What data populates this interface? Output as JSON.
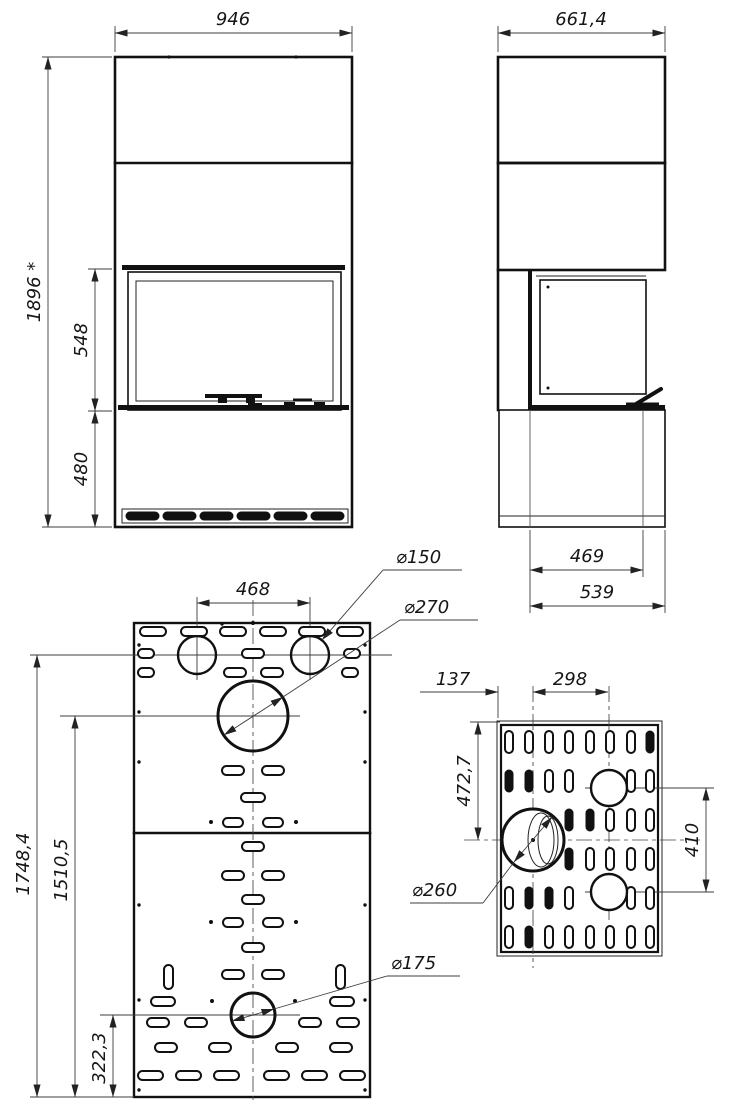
{
  "drawing": {
    "title": "Fireplace dimensional drawing",
    "line_color": "#111111",
    "background": "#ffffff"
  },
  "views": {
    "front": {
      "width": "946",
      "total_height": "1896 *",
      "glass_height": "548",
      "base_height": "480"
    },
    "side": {
      "depth": "661,4",
      "firebox_depth": "469",
      "base_depth": "539"
    },
    "rear_panel": {
      "hole_pitch": "468",
      "top_hole_dia": "⌀150",
      "center_hole_dia": "⌀270",
      "bottom_hole_dia": "⌀175",
      "total_height": "1748,4",
      "center_hole_height": "1510,5",
      "bottom_hole_height": "322,3"
    },
    "side_panel": {
      "front_offset": "137",
      "hole_pitch_h": "298",
      "top_offset": "472,7",
      "hole_pitch_v": "410",
      "main_hole_dia": "⌀260"
    }
  }
}
